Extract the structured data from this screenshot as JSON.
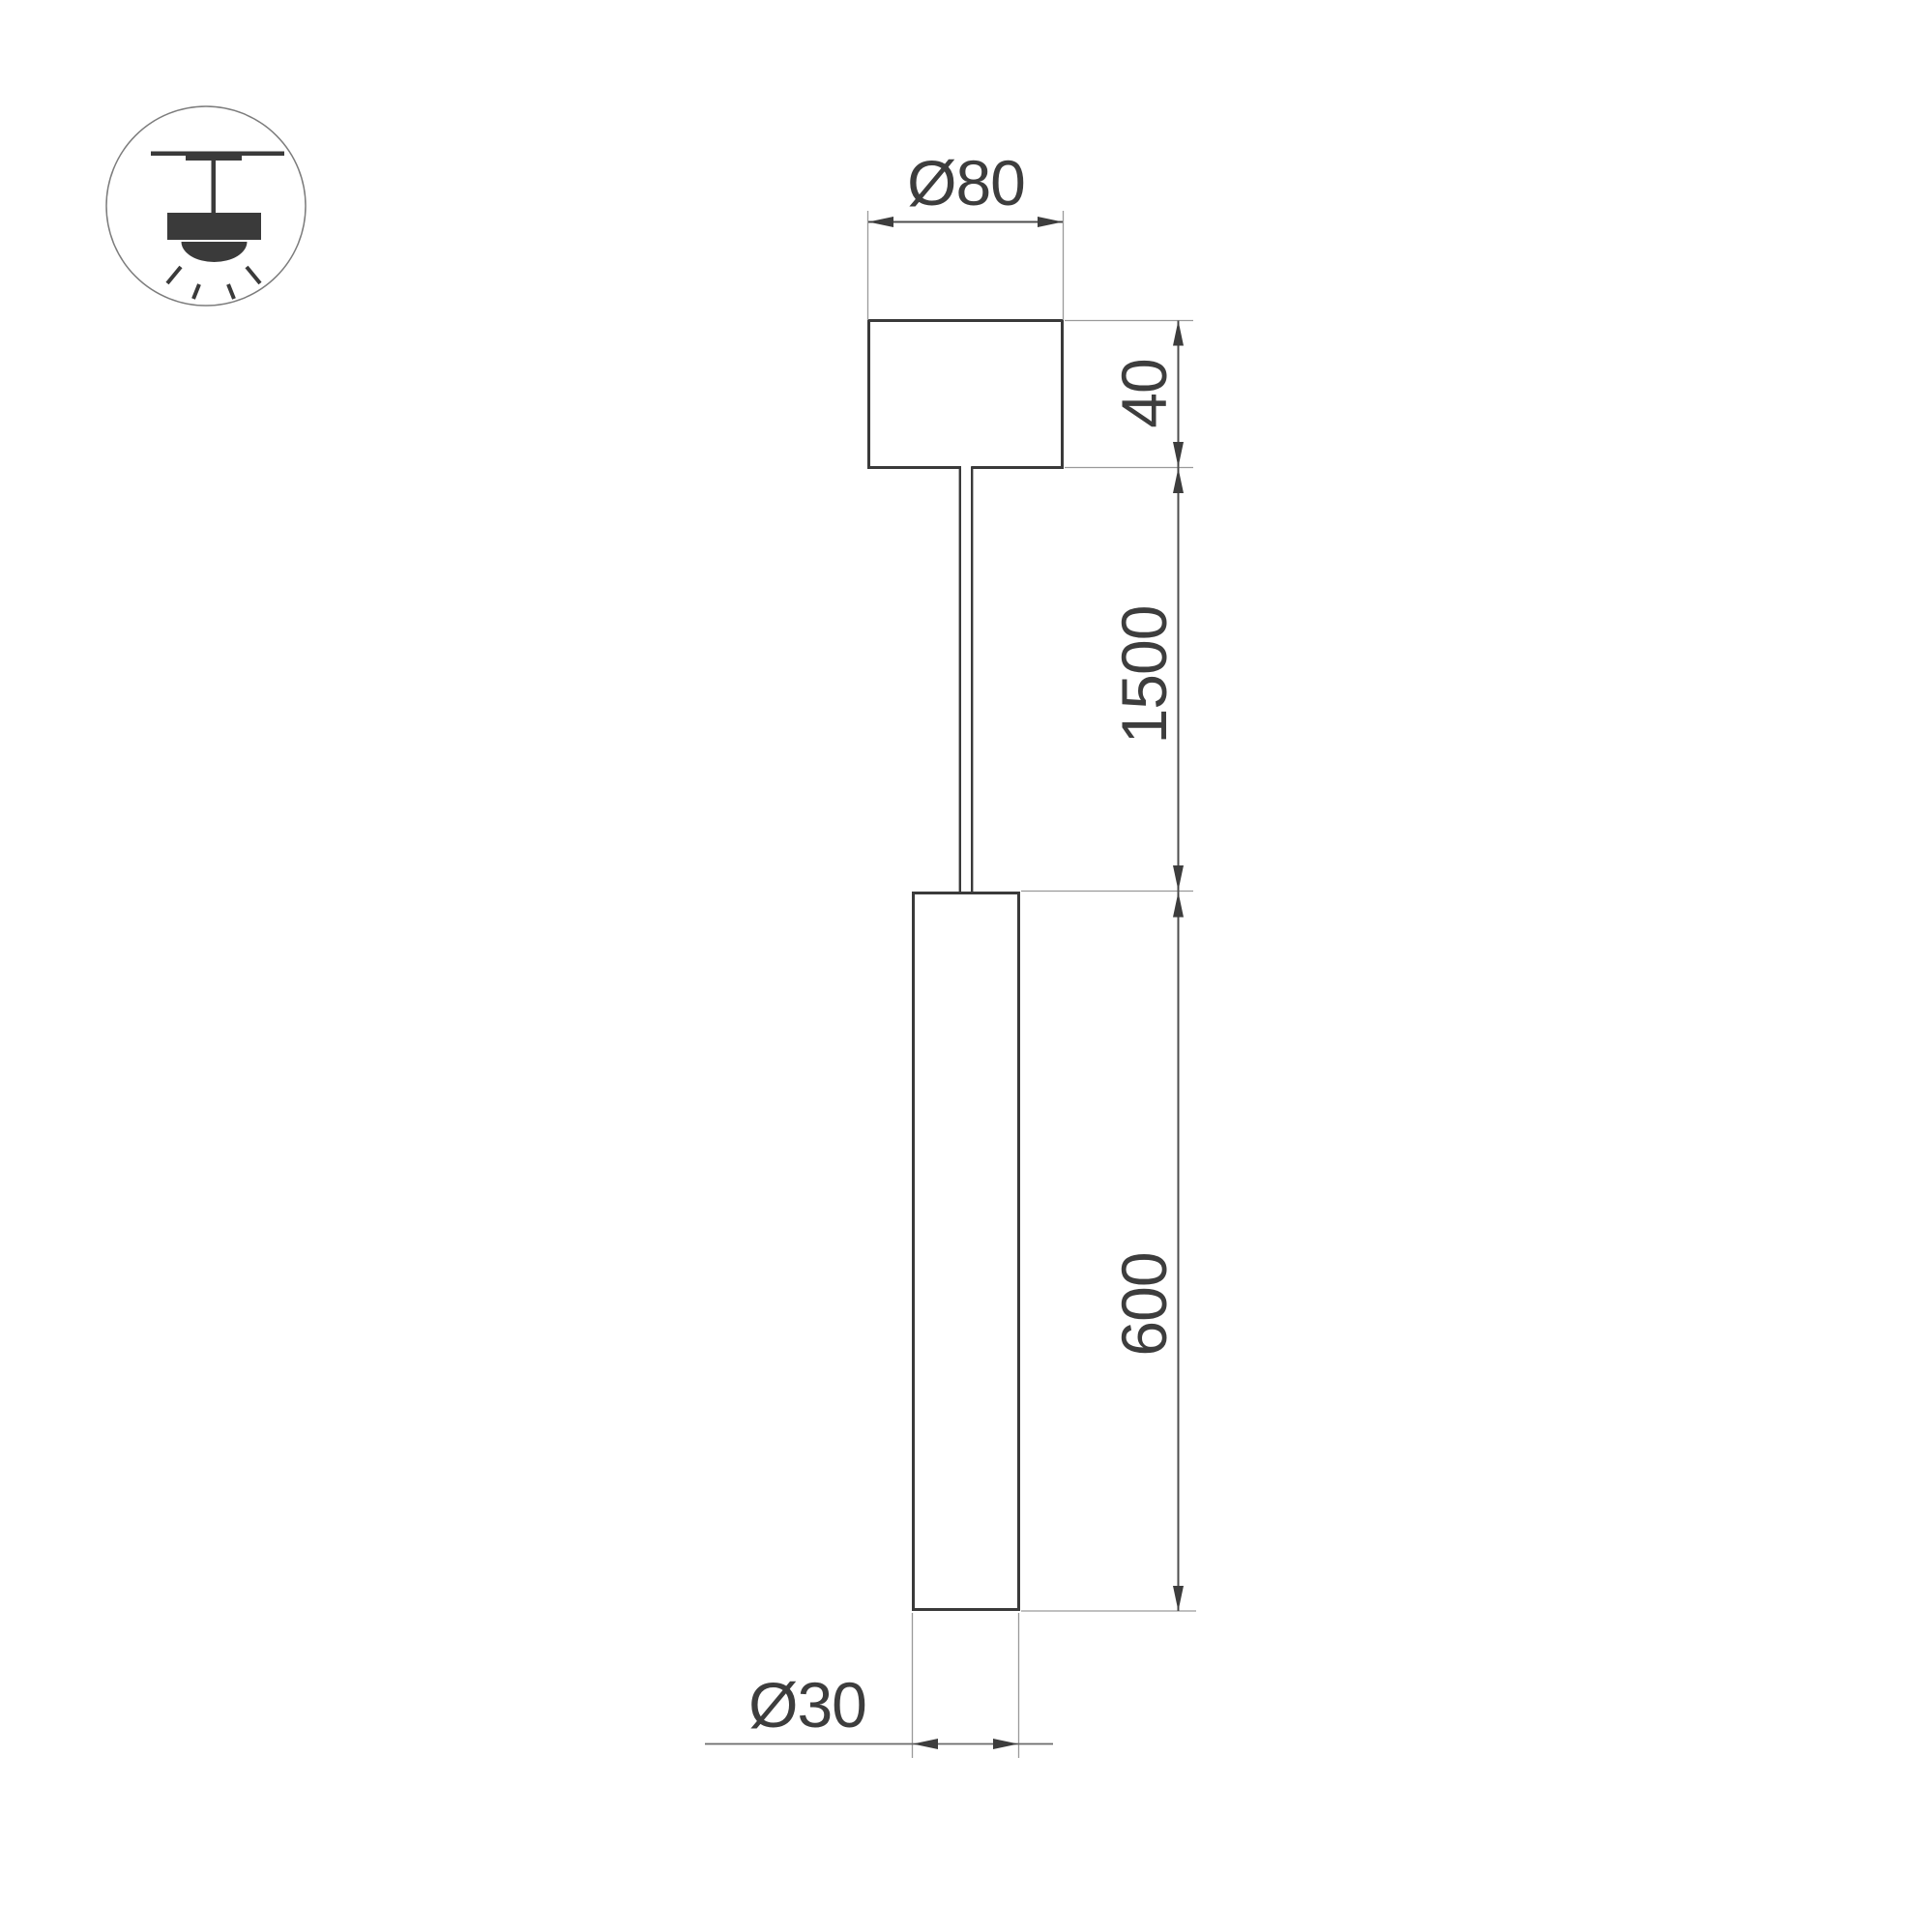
{
  "icon": {
    "name": "pendant-lamp-mounting-icon"
  },
  "dimensions": {
    "canopy_diameter": {
      "label": "Ø80",
      "value": 80
    },
    "canopy_height": {
      "label": "40",
      "value": 40
    },
    "suspension_length": {
      "label": "1500",
      "value": 1500
    },
    "lamp_length": {
      "label": "600",
      "value": 600
    },
    "lamp_diameter": {
      "label": "Ø30",
      "value": 30
    }
  },
  "colors": {
    "background": "#ffffff",
    "outline": "#3a3a3a",
    "dimension_line": "#4d4d4d",
    "extension_line": "#9a9a9a",
    "text": "#3d3d3d"
  }
}
